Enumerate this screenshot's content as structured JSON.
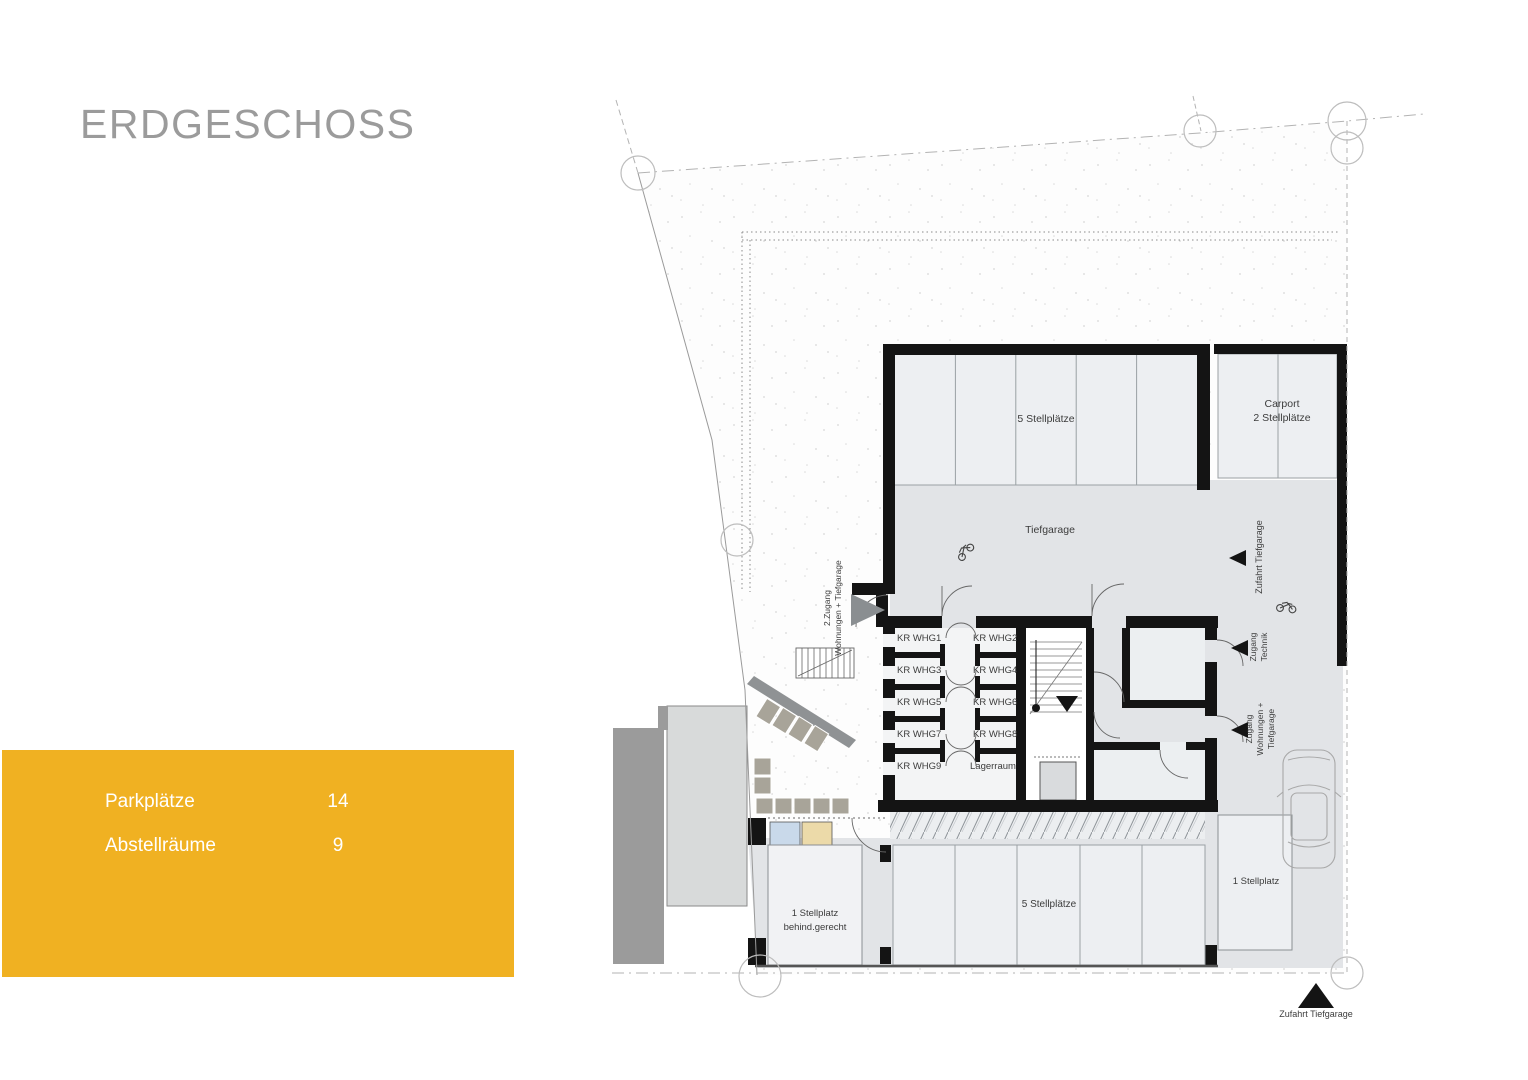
{
  "page": {
    "title": "ERDGESCHOSS"
  },
  "colors": {
    "accent": "#F0B122",
    "title_gray": "#9B9B9B",
    "wall_black": "#141414",
    "garage_gray": "#E2E4E7"
  },
  "info_panel": {
    "rows": [
      {
        "label": "Parkplätze",
        "value": "14"
      },
      {
        "label": "Abstellräume",
        "value": "9"
      }
    ]
  },
  "plan": {
    "areas": {
      "top_parking": "5 Stellplätze",
      "carport_line1": "Carport",
      "carport_line2": "2 Stellplätze",
      "garage": "Tiefgarage",
      "storage_large": "Lagerraum",
      "disabled_parking_line1": "1 Stellplatz",
      "disabled_parking_line2": "behind.gerecht",
      "bottom_parking": "5 Stellplätze",
      "single_parking": "1 Stellplatz"
    },
    "entries": {
      "ramp_side": "Zufahrt Tiefgarage",
      "ramp_bottom": "Zufahrt Tiefgarage",
      "technik_line1": "Zugang",
      "technik_line2": "Technik",
      "wohnungen_line1": "Zugang",
      "wohnungen_line2": "Wohnungen +",
      "wohnungen_line3": "Tiefgarage",
      "second_line1": "2.Zugang",
      "second_line2": "Wohnungen + Tiefgarage"
    },
    "storage_rooms": [
      "KR WHG1",
      "KR WHG2",
      "KR WHG3",
      "KR WHG4",
      "KR WHG5",
      "KR WHG6",
      "KR WHG7",
      "KR WHG8",
      "KR WHG9"
    ]
  }
}
